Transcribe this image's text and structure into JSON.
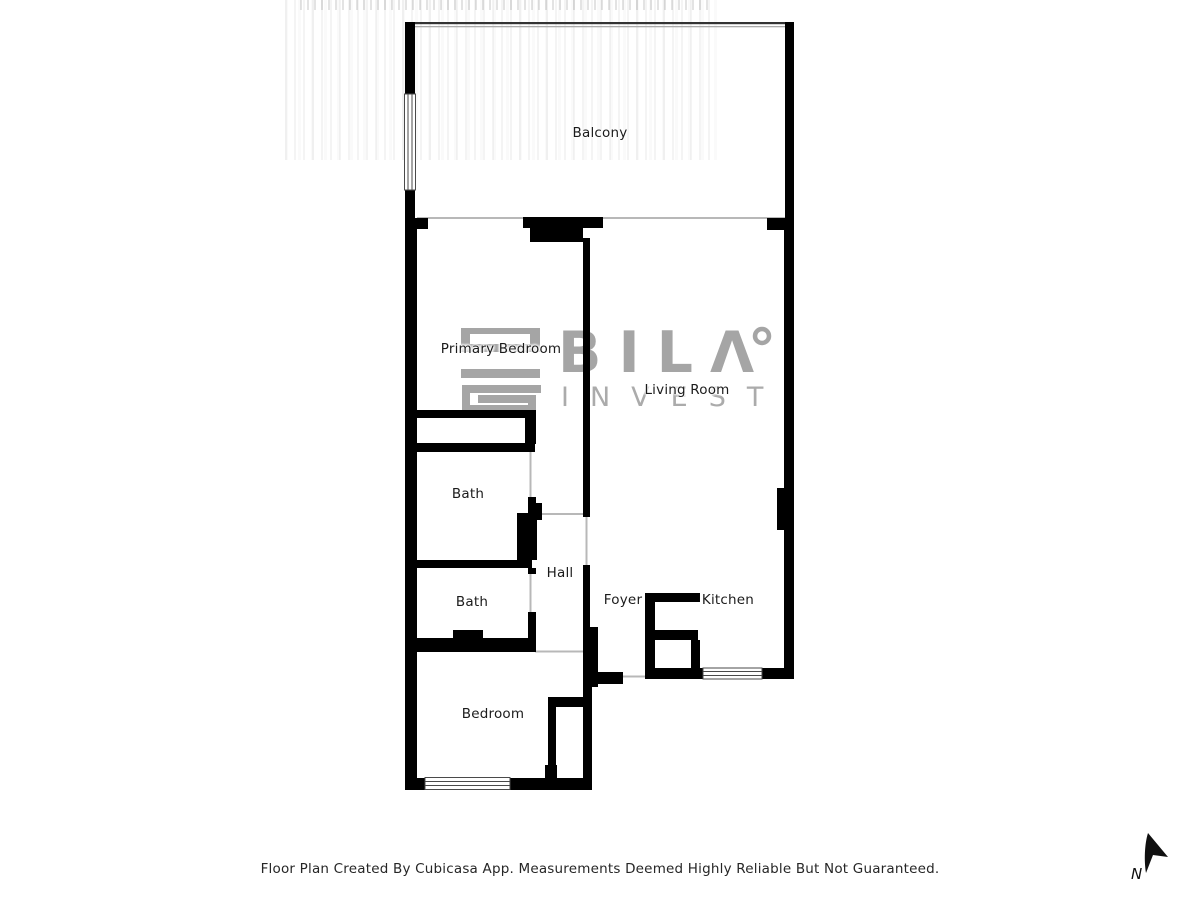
{
  "floorplan": {
    "rooms": [
      {
        "label": "Balcony"
      },
      {
        "label": "Primary Bedroom"
      },
      {
        "label": "Living Room"
      },
      {
        "label": "Bath"
      },
      {
        "label": "Bath"
      },
      {
        "label": "Hall"
      },
      {
        "label": "Foyer"
      },
      {
        "label": "Kitchen"
      },
      {
        "label": "Bedroom"
      }
    ],
    "compass": {
      "north_label": "N"
    },
    "footer_disclaimer": "Floor Plan Created By Cubicasa App. Measurements Deemed Highly Reliable But Not Guaranteed.",
    "watermark": {
      "brand": "BILΛ",
      "sub_brand": "INVEST"
    },
    "colors": {
      "walls": "#000000",
      "watermark_gray": "#a5a5a5",
      "label_text": "#1b1b1b",
      "threshold_gray": "#b8b8b8",
      "window_frame": "#4a4a4a"
    }
  }
}
